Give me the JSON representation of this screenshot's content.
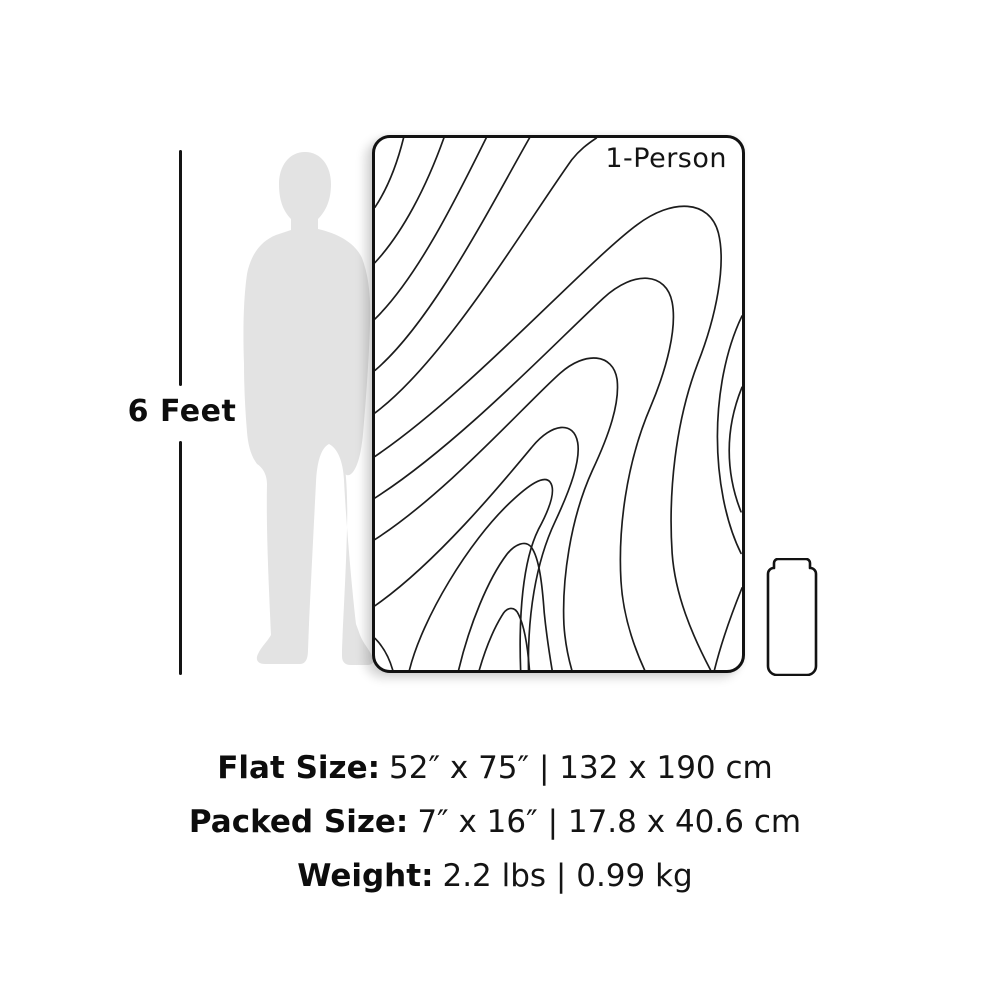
{
  "scale_indicator": {
    "label": "6 Feet"
  },
  "figures": {
    "person_silhouette_color": "#e3e3e3",
    "outline_color": "#141414",
    "topo_line_color": "#1c1c1c"
  },
  "blanket": {
    "badge": "1-Person"
  },
  "specs": {
    "flat": {
      "label": "Flat Size:",
      "value": "52″ x 75″ | 132 x 190 cm"
    },
    "packed": {
      "label": "Packed Size:",
      "value": "7″ x 16″ | 17.8 x 40.6 cm"
    },
    "weight": {
      "label": "Weight:",
      "value": "2.2 lbs | 0.99 kg"
    }
  }
}
